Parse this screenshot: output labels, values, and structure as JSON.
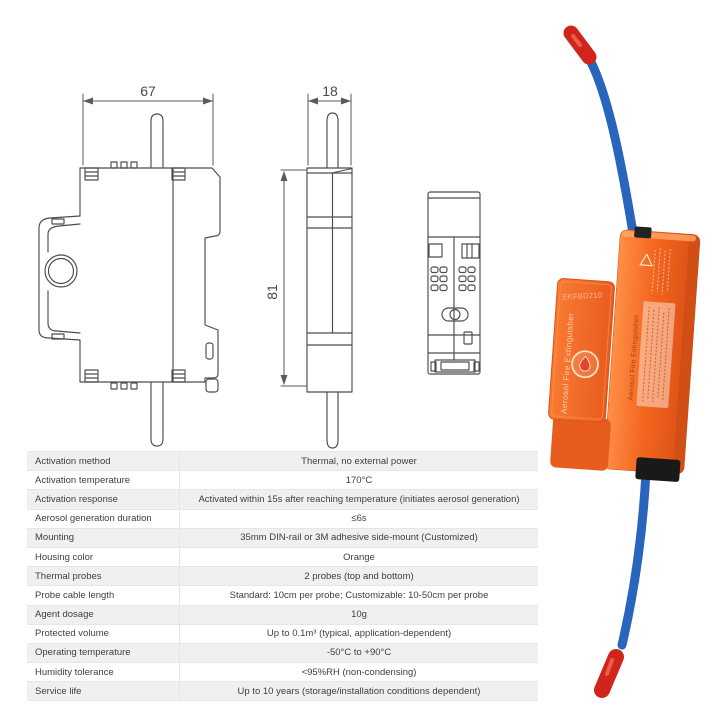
{
  "drawings": {
    "dim_width": "67",
    "dim_depth": "18",
    "dim_height": "81"
  },
  "product": {
    "model": "EKFBD210",
    "label": "Aerosol Fire Extinguisher",
    "side_label": "Aerosol Fire Extinguisher",
    "colors": {
      "housing_orange": "#f4661f",
      "cable_blue": "#2a65bd",
      "probe_tip_red": "#d0251a"
    }
  },
  "specs": {
    "rows": [
      {
        "label": "Activation method",
        "value": "Thermal, no external power"
      },
      {
        "label": "Activation temperature",
        "value": "170°C"
      },
      {
        "label": "Activation response",
        "value": "Activated within 15s after reaching temperature (initiates aerosol generation)"
      },
      {
        "label": "Aerosol generation duration",
        "value": "≤6s"
      },
      {
        "label": "Mounting",
        "value": "35mm DIN-rail or 3M adhesive side-mount (Customized)"
      },
      {
        "label": "Housing color",
        "value": "Orange"
      },
      {
        "label": "Thermal probes",
        "value": "2 probes (top and bottom)"
      },
      {
        "label": "Probe cable length",
        "value": "Standard: 10cm per probe; Customizable: 10-50cm per probe"
      },
      {
        "label": "Agent dosage",
        "value": "10g"
      },
      {
        "label": "Protected volume",
        "value": "Up to 0.1m³ (typical, application-dependent)"
      },
      {
        "label": "Operating temperature",
        "value": "-50°C to +90°C"
      },
      {
        "label": "Humidity tolerance",
        "value": "<95%RH (non-condensing)"
      },
      {
        "label": "Service life",
        "value": "Up to 10 years (storage/installation conditions dependent)"
      }
    ]
  }
}
